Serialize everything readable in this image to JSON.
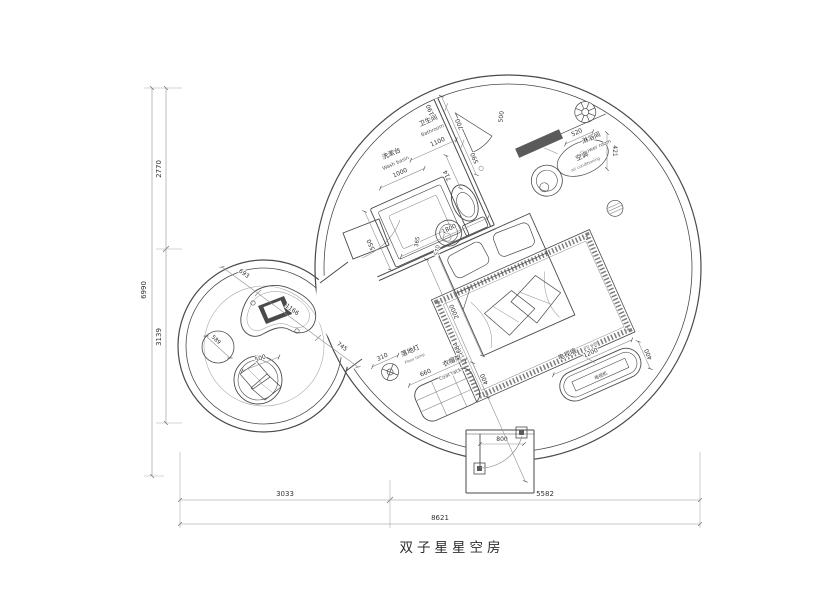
{
  "title": "双子星星空房",
  "colors": {
    "line": "#4a4a4a",
    "dark_fill": "#5a5a5a",
    "background": "#ffffff"
  },
  "labels": {
    "wash_basin": {
      "cn": "洗漱台",
      "en": "Wash basin"
    },
    "bathroom": {
      "cn": "卫生间",
      "en": "Bathroom"
    },
    "shower": {
      "cn": "淋浴间",
      "en": "Shower room"
    },
    "ac": {
      "cn": "空调",
      "en": "air conditioning"
    },
    "floor_lamp": {
      "cn": "落地灯",
      "en": "Floor lamp"
    },
    "coat_rack": {
      "cn": "衣帽架",
      "en": "Coat rack"
    },
    "tv_wall": {
      "cn": "电视墙",
      "en": "TV wall"
    },
    "tv_set": {
      "cn": "电视机"
    }
  },
  "dims": {
    "overall_height": "6990",
    "height_upper": "2770",
    "height_lower": "3139",
    "width_left": "3033",
    "width_right": "5582",
    "width_total": "8621",
    "wall_top": "190",
    "bath_wall": "700",
    "shower_door": "500",
    "wall_lower": "590",
    "ac_width": "520",
    "ac_depth": "421",
    "bathroom_width": "1100",
    "basin_width": "1000",
    "counter_depth": "550",
    "toilet": "714",
    "bath_zone": "1800",
    "sink_a": "365",
    "sink_b": "570",
    "bed_length": "2000",
    "room_diag": "5684",
    "table_a": "693",
    "table_b": "1166",
    "table_c": "745",
    "ottoman": "589",
    "chair": "500",
    "lamp": "310",
    "rack_width": "660",
    "rack_depth": "400",
    "tv_width": "1200",
    "tv_depth": "400",
    "entry_door": "800"
  }
}
